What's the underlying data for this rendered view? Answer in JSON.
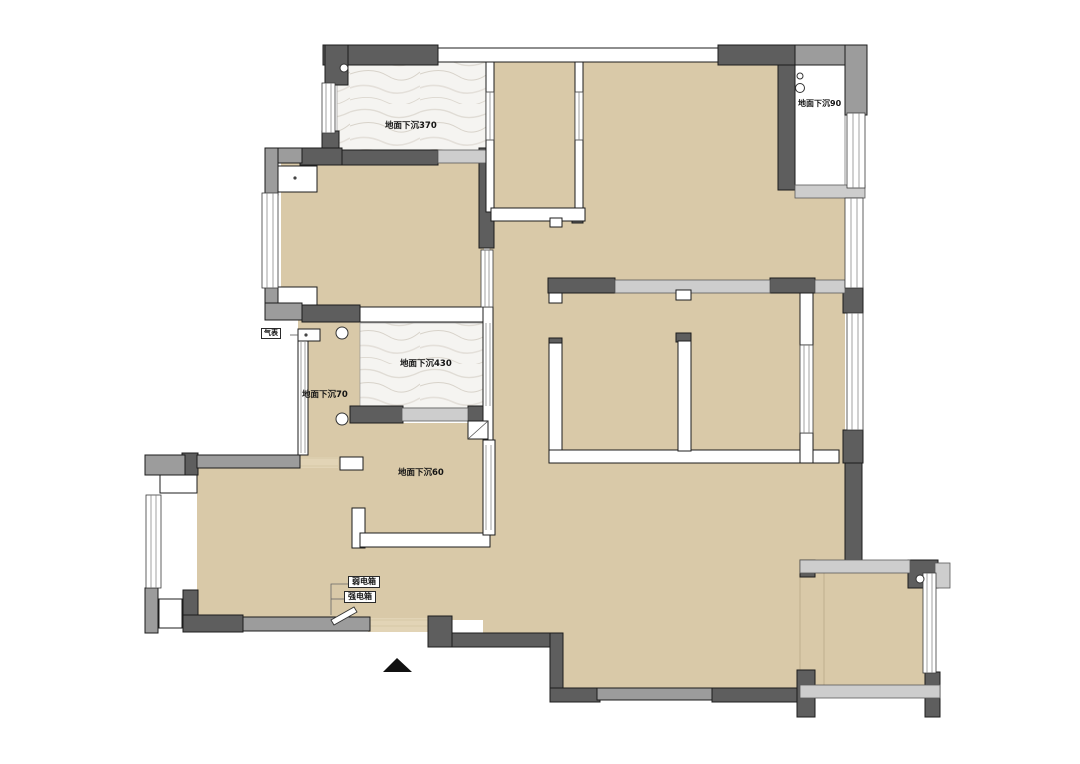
{
  "plan": {
    "rooms": [
      {
        "id": "top-balcony",
        "label": "地面下沉370",
        "finish": "marble"
      },
      {
        "id": "top-right-recess",
        "label": "地面下沉90",
        "finish": "white"
      },
      {
        "id": "mid-marble",
        "label": "地面下沉430",
        "finish": "marble"
      },
      {
        "id": "left-corridor",
        "label": "地面下沉70",
        "finish": "floor"
      },
      {
        "id": "mid-room",
        "label": "地面下沉60",
        "finish": "floor"
      }
    ],
    "callouts": [
      {
        "id": "weak-current-box",
        "label": "弱电箱"
      },
      {
        "id": "strong-current-box",
        "label": "强电箱"
      },
      {
        "id": "gas-meter",
        "label": "气表"
      }
    ],
    "colors": {
      "floor": "#d9c9a8",
      "wood": "#e2d4b6",
      "wall_dark": "#5e5e5e",
      "wall_medium": "#9c9c9c",
      "wall_light": "#cdcdcd",
      "outline": "#1c1c1c",
      "marble_base": "#f5f4f1"
    }
  }
}
